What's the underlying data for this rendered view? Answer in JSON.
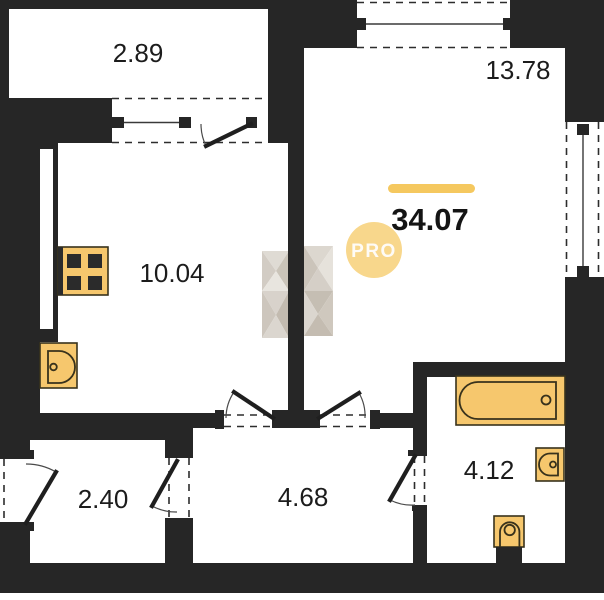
{
  "title": "apartment-floor-plan",
  "total_area": "34.07",
  "badge_label": "PRO",
  "rooms": {
    "balcony_top": "2.89",
    "living_room": "13.78",
    "kitchen": "10.04",
    "entry_closet": "2.40",
    "hallway": "4.68",
    "bathroom": "4.12"
  },
  "colors": {
    "wall": "#262626",
    "fixture_fill": "#f6c76d",
    "fixture_outline": "#38321c",
    "accent_bar": "#f5c85f",
    "badge_fill": "#f8d78c",
    "badge_text": "#ffffff",
    "label": "#1c1c1c",
    "background": "#ffffff"
  }
}
